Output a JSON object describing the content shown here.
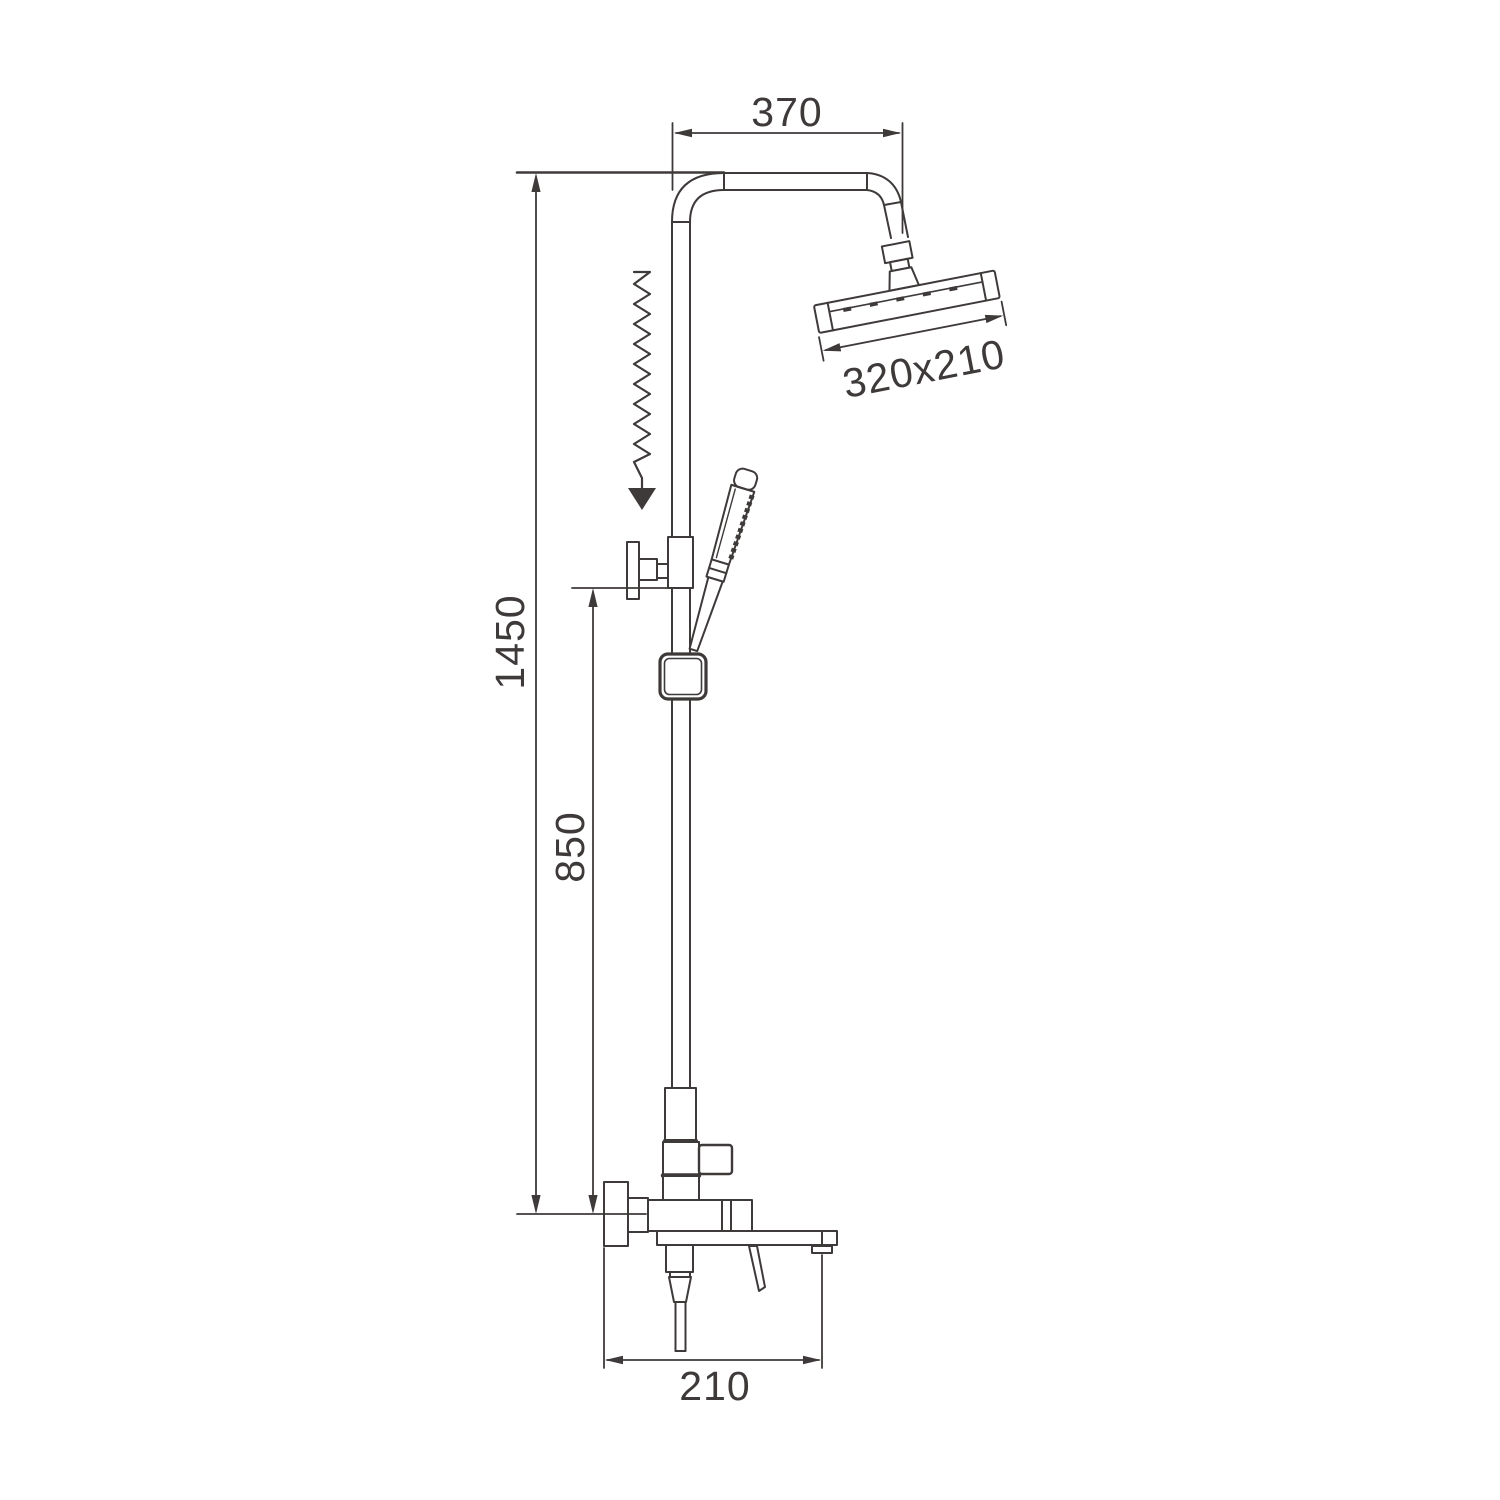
{
  "drawing": {
    "kind": "technical-dimension-drawing",
    "line_color": "#3e3a39",
    "background": "#ffffff",
    "dimensions": {
      "top_arm_width": "370",
      "head_size": "320x210",
      "total_height": "1450",
      "lower_height": "850",
      "spout_width": "210"
    }
  }
}
